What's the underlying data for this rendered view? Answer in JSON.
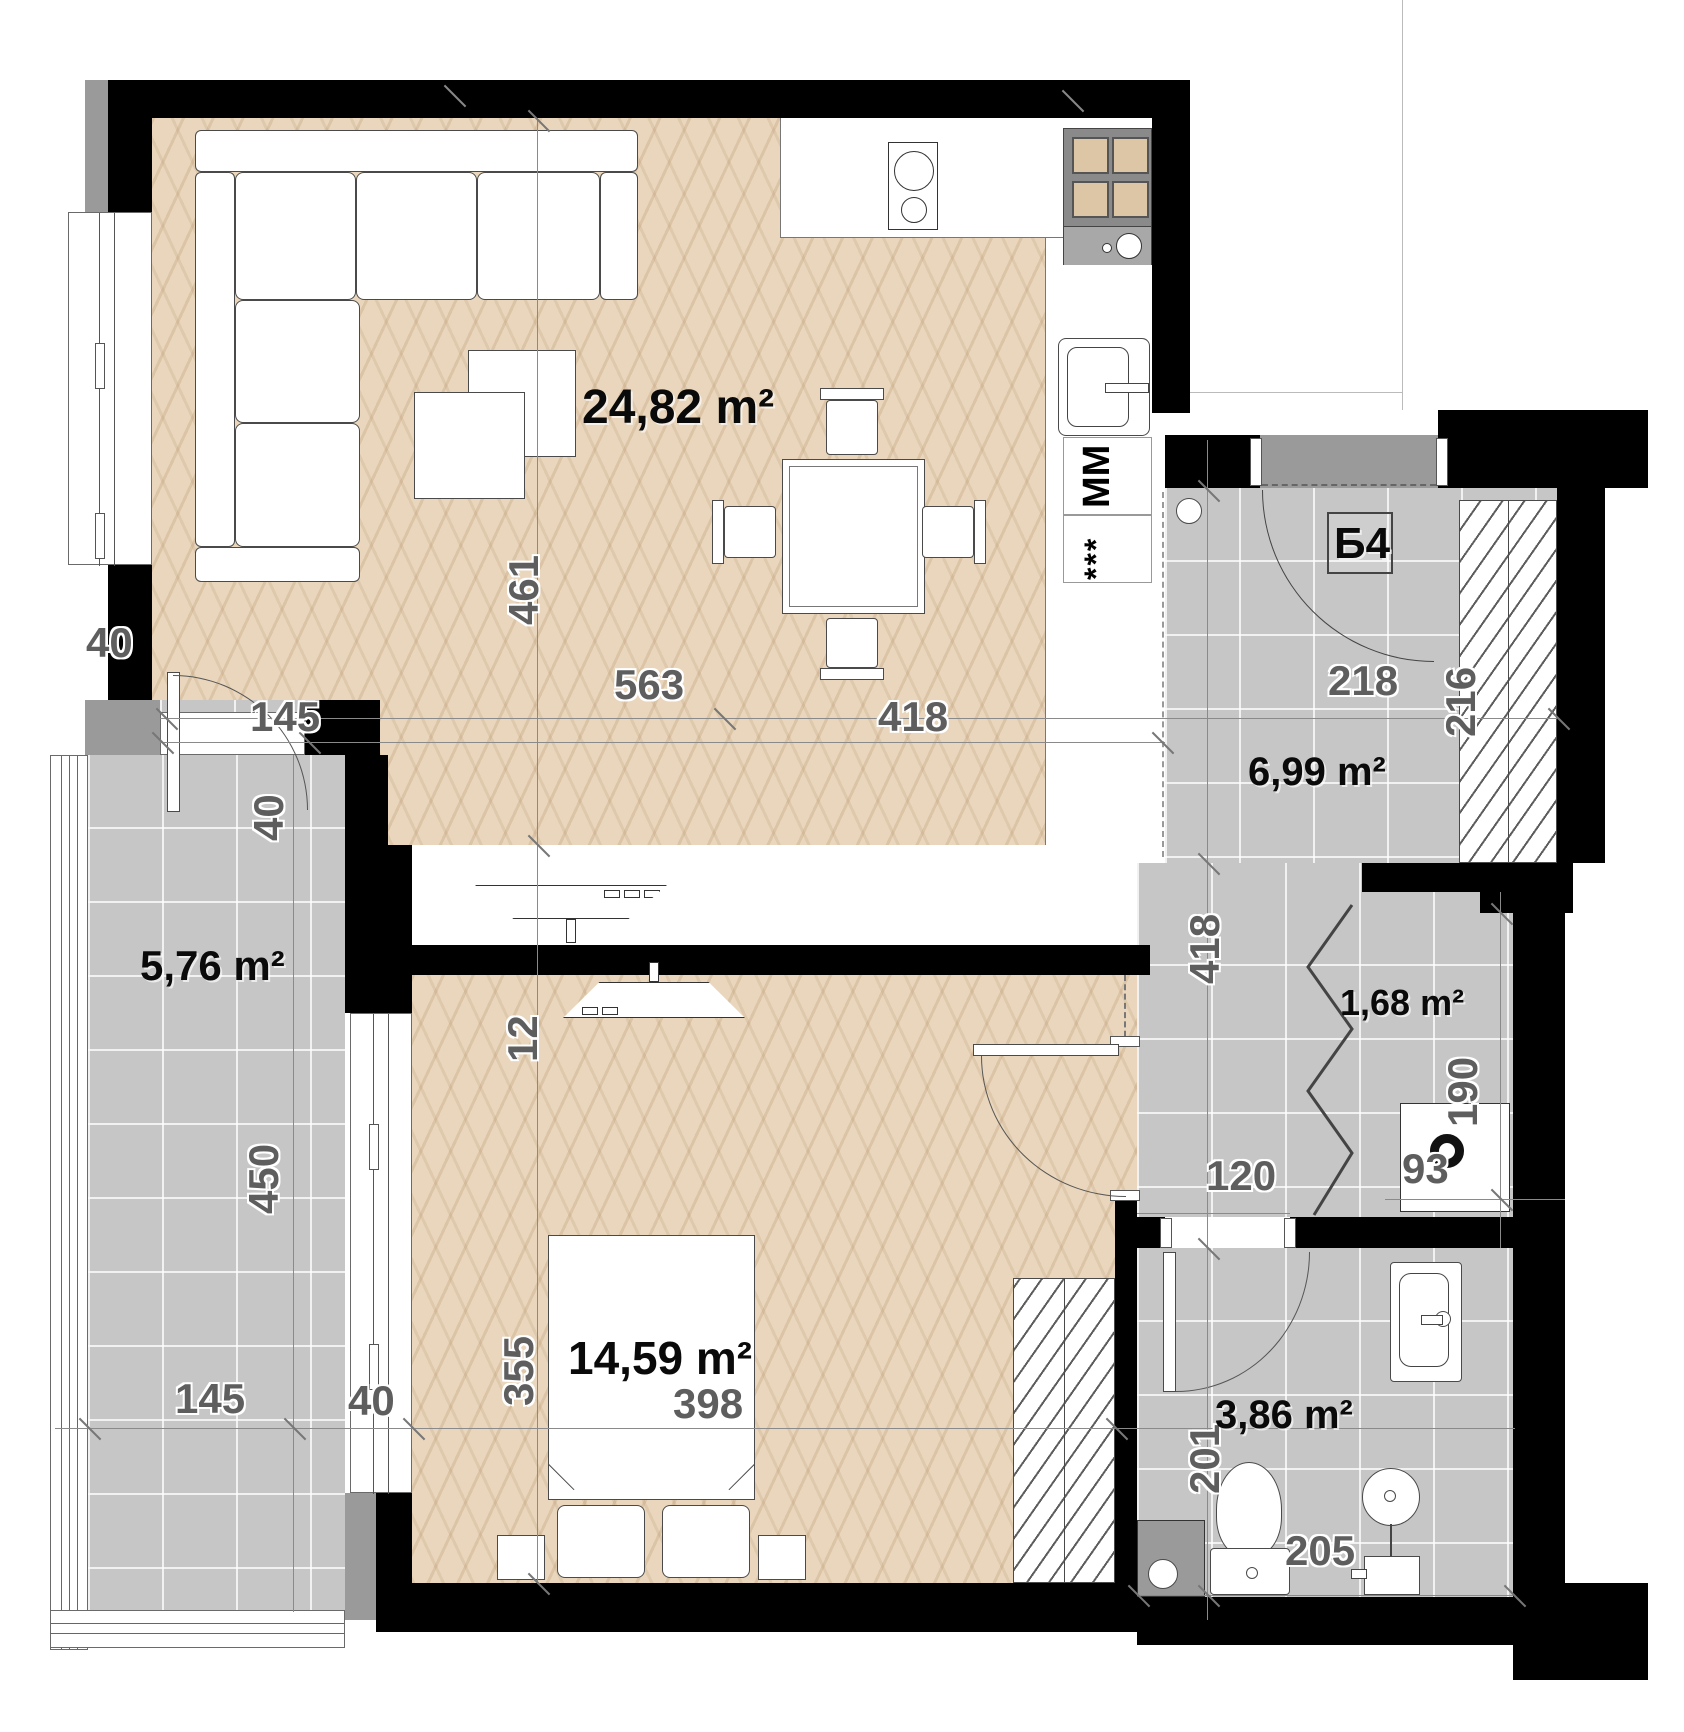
{
  "unit": {
    "label": "Б4"
  },
  "rooms": {
    "living": {
      "area": "24,82 m²"
    },
    "bedroom": {
      "area": "14,59 m²"
    },
    "hall": {
      "area": "6,99 m²"
    },
    "closet": {
      "area": "1,68 m²"
    },
    "bathroom": {
      "area": "3,86 m²"
    },
    "balcony": {
      "area": "5,76 m²"
    }
  },
  "appliances": {
    "washing_machine": "ММ",
    "dishwasher_stars": "***"
  },
  "dims": {
    "living_depth": "461",
    "living_w1": "563",
    "living_w2": "418",
    "living_door": "145",
    "door_reveal": "40",
    "window_side": "40",
    "hall_w": "218",
    "hall_wardrobe_d": "216",
    "hall_depth": "418",
    "closet_d": "190",
    "corridor_w": "120",
    "closet_w": "93",
    "bath_d": "201",
    "bath_w": "205",
    "bedroom_d": "355",
    "wall_t": "12",
    "bedroom_w": "398",
    "balcony_d": "450",
    "balcony_w": "145",
    "balcony_side": "40"
  },
  "colors": {
    "wall": "#000000",
    "tile_floor": "#c6c6c6",
    "wood_floor": "#e9d6bc",
    "trim_gray": "#9a9a9a"
  }
}
